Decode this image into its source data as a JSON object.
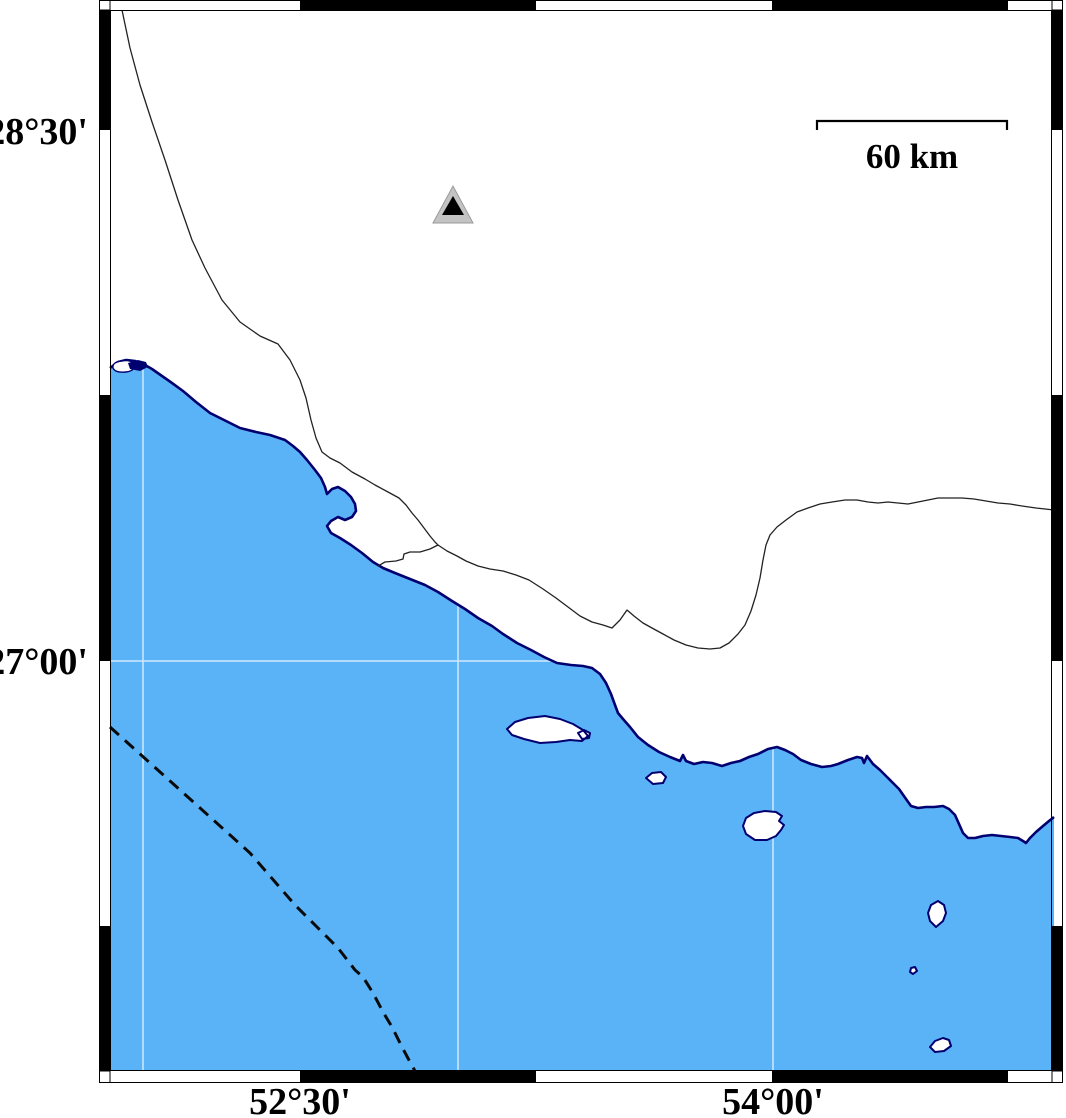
{
  "axis": {
    "lat_labels": [
      {
        "text": "28°30'"
      },
      {
        "text": "27°00'"
      }
    ],
    "lon_labels": [
      {
        "text": "52°30'"
      },
      {
        "text": "54°00'"
      }
    ]
  },
  "scale_bar": {
    "label": "60 km"
  },
  "colors": {
    "sea": "#5bb3f7",
    "coast": "#000070",
    "land_line": "#222222",
    "grid": "rgba(255,255,255,0.7)",
    "marker_gray": "#c3c3c3",
    "marker_black": "#000000"
  },
  "geometry": {
    "sea": "M110,368 L118,362 L126,360 L135,361 L145,365 L152,369 L162,376 L172,383 L183,391 L196,402 L210,413 L224,420 L240,428 L256,432 L270,435 L285,440 L293,446 L300,452 L307,460 L315,470 L321,478 L325,487 L327,494 L332,489 L338,487 L345,491 L351,497 L355,504 L356,511 L352,517 L345,520 L338,517 L331,521 L327,526 L331,533 L340,538 L351,545 L362,553 L373,562 L383,568 L395,573 L410,579 L425,585 L438,592 L452,601 L465,609 L478,618 L492,626 L503,634 L517,643 L531,650 L544,657 L557,663 L571,665 L583,666 L592,668 L600,674 L606,683 L611,694 L615,705 L618,713 L623,719 L630,727 L638,737 L648,745 L659,752 L670,757 L680,761 L683,755 L686,761 L694,764 L703,762 L712,763 L722,766 L731,763 L740,761 L749,757 L758,754 L768,749 L777,747 L785,750 L793,754 L801,760 L811,764 L822,767 L831,766 L838,764 L848,760 L857,757 L862,758 L864,763 L867,756 L873,764 L880,770 L887,777 L893,783 L899,789 L906,799 L911,806 L918,808 L926,807 L934,807 L943,806 L949,809 L955,815 L959,824 L963,833 L968,838 L975,838 L983,836 L992,835 L1001,836 L1010,837 L1018,838 L1023,841 L1026,843 L1030,838 L1036,832 L1043,826 L1049,821 L1054,817 L1054,1071 L110,1071 Z",
    "coastline": "M110,368 L118,362 L126,360 L135,361 L145,365 L152,369 L162,376 L172,383 L183,391 L196,402 L210,413 L224,420 L240,428 L256,432 L270,435 L285,440 L293,446 L300,452 L307,460 L315,470 L321,478 L325,487 L327,494 L332,489 L338,487 L345,491 L351,497 L355,504 L356,511 L352,517 L345,520 L338,517 L331,521 L327,526 L331,533 L340,538 L351,545 L362,553 L373,562 L383,568 L395,573 L410,579 L425,585 L438,592 L452,601 L465,609 L478,618 L492,626 L503,634 L517,643 L531,650 L544,657 L557,663 L571,665 L583,666 L592,668 L600,674 L606,683 L611,694 L615,705 L618,713 L623,719 L630,727 L638,737 L648,745 L659,752 L670,757 L680,761 L683,755 L686,761 L694,764 L703,762 L712,763 L722,766 L731,763 L740,761 L749,757 L758,754 L768,749 L777,747 L785,750 L793,754 L801,760 L811,764 L822,767 L831,766 L838,764 L848,760 L857,757 L862,758 L864,763 L867,756 L873,764 L880,770 L887,777 L893,783 L899,789 L906,799 L911,806 L918,808 L926,807 L934,807 L943,806 L949,809 L955,815 L959,824 L963,833 L968,838 L975,838 L983,836 L992,835 L1001,836 L1010,837 L1018,838 L1023,841 L1026,843 L1030,838 L1036,832 L1043,826 L1049,821 L1054,817",
    "gridlines": "M143,366 V1071 M458,605 V1071 M773,749 V1071 M110,661 H554",
    "lagoon_white": "M113,368 Q112,362 122,361 Q132,359 134,365 Q135,371 126,372 Q115,373 113,368 Z",
    "lagoon_dark": "M128,363 L138,360 L146,362 L148,367 L140,371 L130,369 Z",
    "land_lines": "M122,10 L130,48 L140,85 L152,122 L165,160 L178,200 L192,240 L205,268 L222,300 L240,322 L260,336 L278,344 L290,360 L300,380 L306,398 L311,420 L316,438 L322,452 L330,458 L340,463 L352,472 L365,479 L375,485 L388,492 L399,498 L406,505 L412,513 L418,520 L424,528 L430,536 L435,542 L438,545 L430,549 L420,552 L410,552 L404,554 L403,559 L396,561 L385,562 L378,566 M438,545 L447,551 L457,556 L466,561 L478,566 L490,569 L503,571 L516,575 L529,580 L543,589 L556,598 L568,607 L580,616 L592,622 L603,625 L612,628 L620,620 L627,610 L634,616 L643,623 L652,628 L663,634 L674,640 L686,645 L698,648 L710,649 L720,648 L729,643 L738,634 L745,625 L751,611 L756,595 L760,578 L763,560 L766,545 L770,535 L777,527 L786,520 L797,512 L808,508 L820,504 L832,502 L845,500 L857,500 L868,502 L878,503 L888,502 L898,503 L908,504 L918,502 L928,500 L938,498 L950,498 L962,498 L974,499 L986,501 L998,503 L1010,504 L1022,506 L1036,508 L1054,510",
    "dashed_line": "M110,727 L150,763 L210,817 L250,853 L295,905 L317,927 L338,948 L355,970 L363,977 L373,993 L383,1012 L392,1027 L402,1047 L410,1062 L415,1071",
    "islands": "M507,729 L515,722 L528,718 L545,716 L560,719 L573,724 L583,730 L588,736 L582,741 L570,740 L556,742 L540,743 L524,739 L512,735 Z M578,733 L584,730 L590,733 L589,738 L582,739 Z M646,778 L652,773 L661,772 L666,777 L663,783 L653,784 Z M743,826 L746,818 L754,813 L765,811 L776,812 L782,816 L779,821 L784,825 L781,830 L776,836 L767,840 L755,840 L746,834 Z M928,913 L931,905 L938,901 L944,905 L946,913 L943,921 L936,927 L930,921 Z M911,968 L915,967 L917,971 L913,974 L910,972 Z M930,1047 L935,1041 L943,1038 L949,1040 L951,1046 L944,1051 L935,1052 Z",
    "frame_black": "M300,0 H536 V10 H300 Z M772,0 H1008 V10 H772 Z M300,1071 H536 V1082 H300 Z M772,1071 H1008 V1082 H772 Z M99,10 H110 V130 H99 Z M99,395 H110 V661 H99 Z M99,926 H110 V1071 H99 Z M1052,10 H1063 V130 H1052 Z M1052,395 H1063 V661 H1052 Z M1052,926 H1063 V1071 H1052 Z",
    "frame_outline": "M99.5,0.5 H1062.5 V1082.5 H99.5 Z M110.5,10.5 H1051.5 V1070.5 H110.5 Z M110,0 V10 M1052,0 V10 M110,1071 V1082 M1052,1071 V1082 M99,10 H110 M1052,10 H1063 M99,1071 H110 M1052,1071 H1063",
    "triangle_outer": "M433,223 L473,223 L453,186 Z",
    "triangle_inner": "M442,215 L464,215 L453,196 Z",
    "scalebar": "M817,130 L817,121 L1007,121 L1007,130"
  }
}
